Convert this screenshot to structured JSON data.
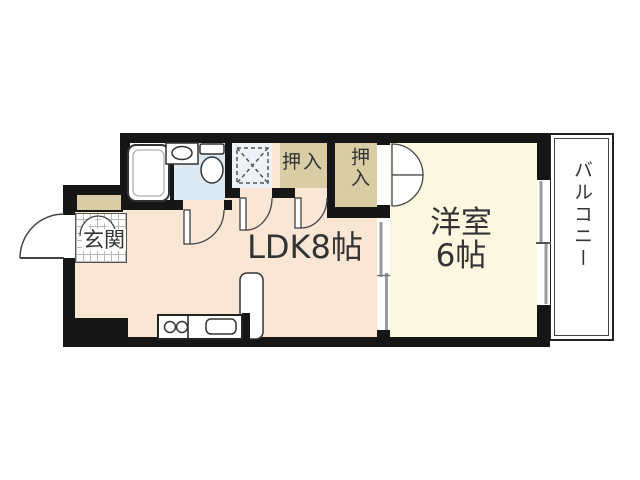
{
  "plan": {
    "type": "apartment-floor-plan",
    "rooms": {
      "ldk": {
        "label": "LDK8帖"
      },
      "western_room": {
        "label_line1": "洋室",
        "label_line2": "6帖"
      },
      "genkan": {
        "label": "玄関"
      },
      "closet1": {
        "label": "押入"
      },
      "closet2": {
        "label": "押入"
      },
      "balcony": {
        "label": "バルコニー"
      }
    },
    "fixtures": [
      "bathtub",
      "wash-basin",
      "toilet",
      "washing-machine-space",
      "kitchen-counter",
      "stove-burners",
      "kitchen-sink",
      "shoe-cabinet"
    ],
    "colors": {
      "wall": "#161616",
      "ldk_floor": "#fae6d4",
      "western_room_floor": "#fbf7e0",
      "closet": "#d9cda6",
      "bathroom_floor": "#dde9f3",
      "balcony_floor": "#ffffff",
      "text": "#333333"
    }
  }
}
